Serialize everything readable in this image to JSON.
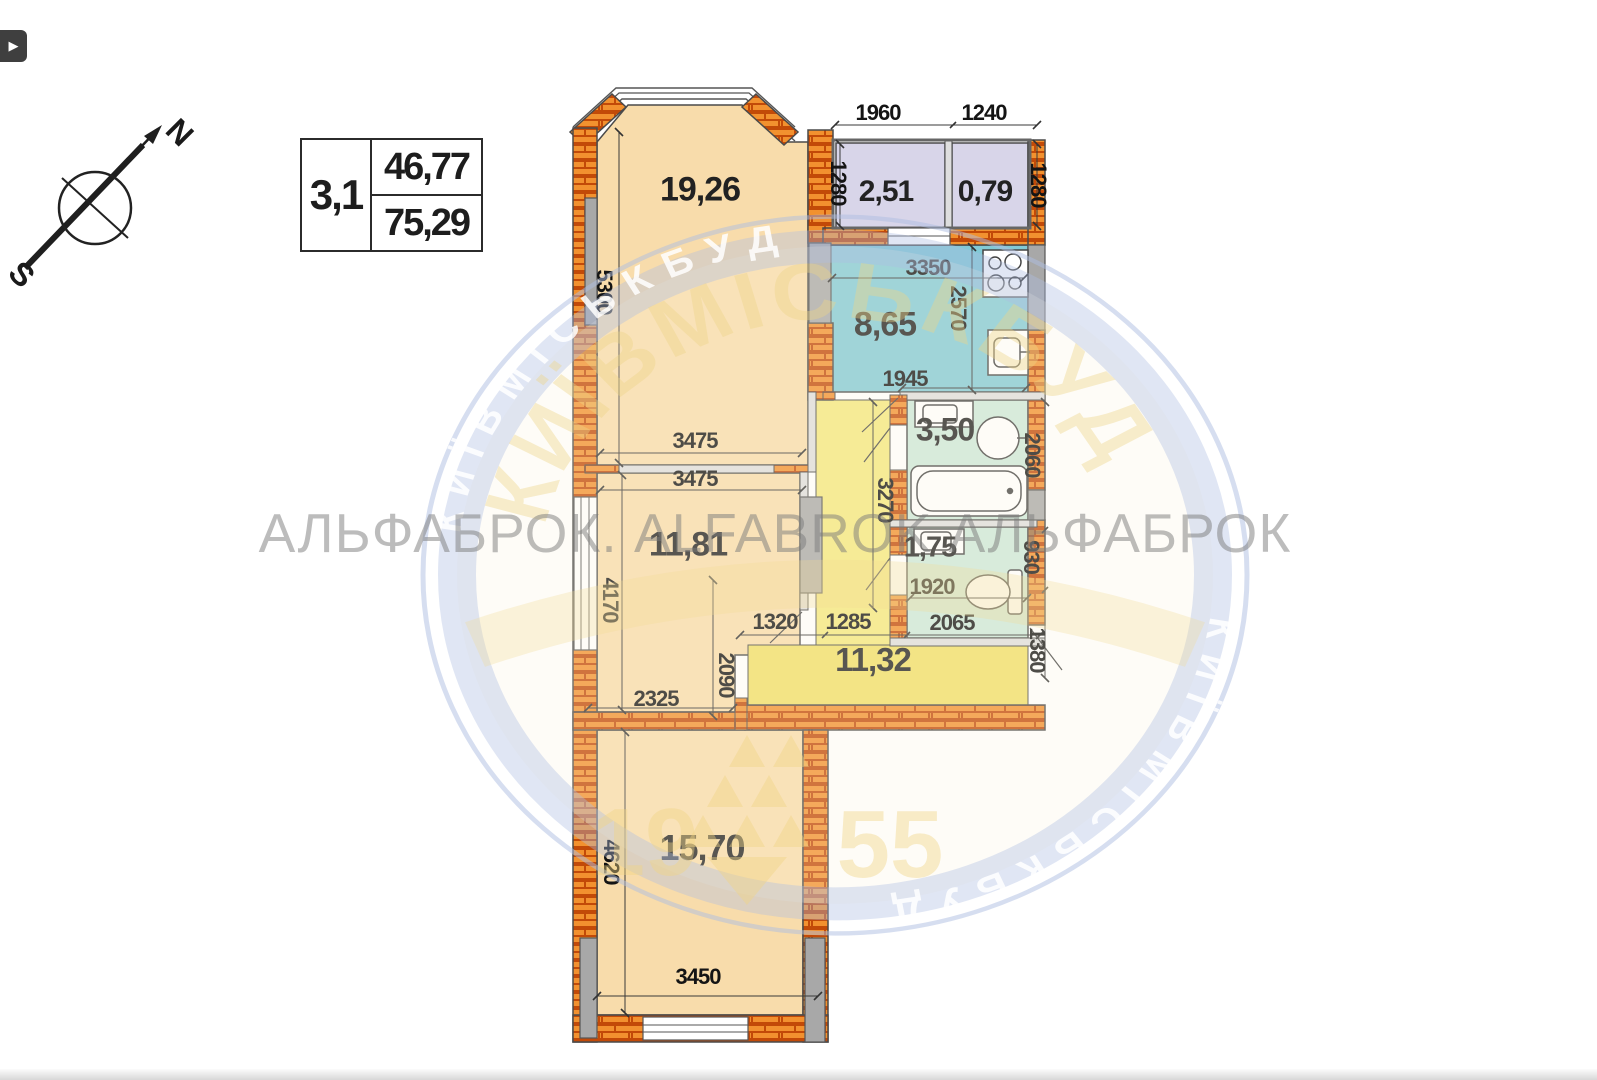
{
  "viewer": {
    "play_icon": "▶"
  },
  "compass": {
    "north": "N",
    "south": "S"
  },
  "info_box": {
    "unit": "3,1",
    "upper_area": "46,77",
    "lower_area": "75,29"
  },
  "watermark": {
    "line": "АЛЬФАБРОК. ALFABROK АЛЬФАБРОК",
    "ring_text": "КИЇВМІСЬКБУД",
    "year_left": "19",
    "year_right": "55"
  },
  "rooms": [
    {
      "id": "living-room",
      "area": "19,26"
    },
    {
      "id": "loggia-left",
      "area": "2,51"
    },
    {
      "id": "loggia-right",
      "area": "0,79"
    },
    {
      "id": "kitchen",
      "area": "8,65"
    },
    {
      "id": "bathroom",
      "area": "3,50"
    },
    {
      "id": "wc",
      "area": "1,75"
    },
    {
      "id": "bedroom",
      "area": "11,81"
    },
    {
      "id": "hallway",
      "area": "11,32"
    },
    {
      "id": "bedroom-2",
      "area": "15,70"
    }
  ],
  "dimensions": [
    {
      "value": "1960"
    },
    {
      "value": "1240"
    },
    {
      "value": "1280"
    },
    {
      "value": "1280"
    },
    {
      "value": "5300"
    },
    {
      "value": "3350"
    },
    {
      "value": "2570"
    },
    {
      "value": "1945"
    },
    {
      "value": "3475"
    },
    {
      "value": "3475"
    },
    {
      "value": "3270"
    },
    {
      "value": "2060"
    },
    {
      "value": "930"
    },
    {
      "value": "1380"
    },
    {
      "value": "1920"
    },
    {
      "value": "4170"
    },
    {
      "value": "2090"
    },
    {
      "value": "1320"
    },
    {
      "value": "1285"
    },
    {
      "value": "2065"
    },
    {
      "value": "2325"
    },
    {
      "value": "4620"
    },
    {
      "value": "3450"
    }
  ]
}
